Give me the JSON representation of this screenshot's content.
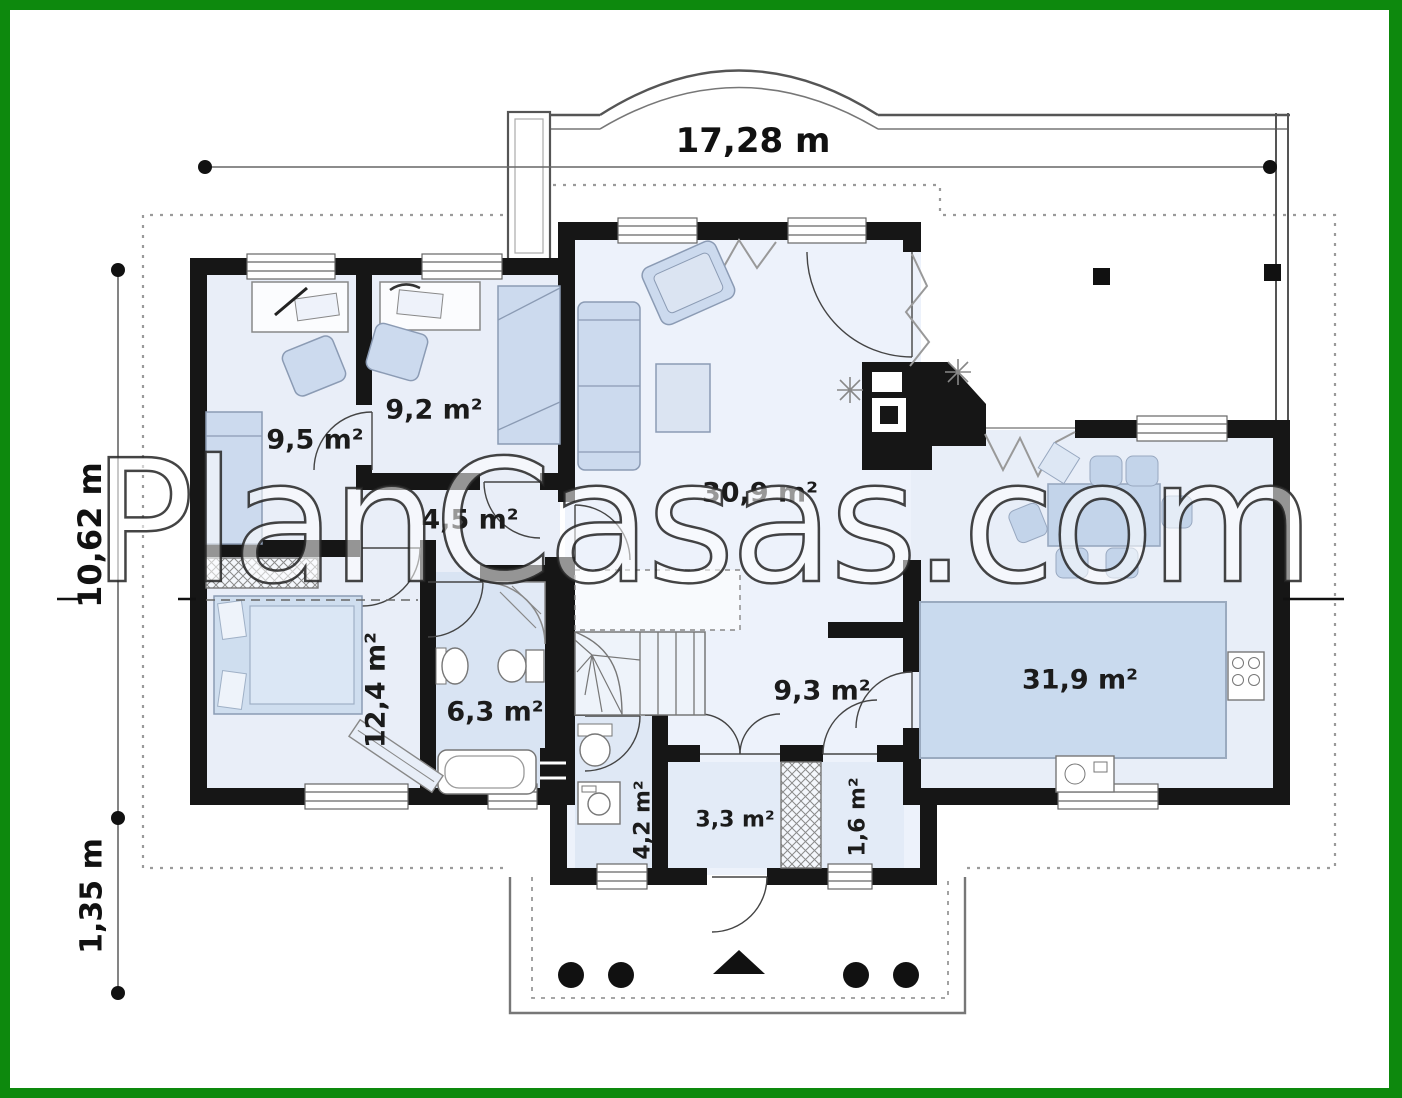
{
  "watermark": {
    "text": "PlanCasas.com"
  },
  "dimensions": {
    "total_width": "17,28 m",
    "total_depth": "10,62 m",
    "porch_depth": "1,35 m"
  },
  "rooms": [
    {
      "id": "bedroom-1",
      "area": "9,5 m²"
    },
    {
      "id": "bedroom-2",
      "area": "9,2 m²"
    },
    {
      "id": "inner-hallway",
      "area": "4,5 m²"
    },
    {
      "id": "living-room",
      "area": "30,9 m²"
    },
    {
      "id": "bedroom-3",
      "area": "12,4 m²"
    },
    {
      "id": "bathroom",
      "area": "6,3 m²"
    },
    {
      "id": "hall",
      "area": "9,3 m²"
    },
    {
      "id": "kitchen-dining",
      "area": "31,9 m²"
    },
    {
      "id": "utility-wc",
      "area": "4,2 m²"
    },
    {
      "id": "vestibule",
      "area": "3,3 m²"
    },
    {
      "id": "closet",
      "area": "1,6 m²"
    }
  ],
  "colors": {
    "frame_green": "#0d890d",
    "wall_black": "#161616",
    "floor_blue": "#e9eef8",
    "furniture_blue": "#ccdaee"
  }
}
